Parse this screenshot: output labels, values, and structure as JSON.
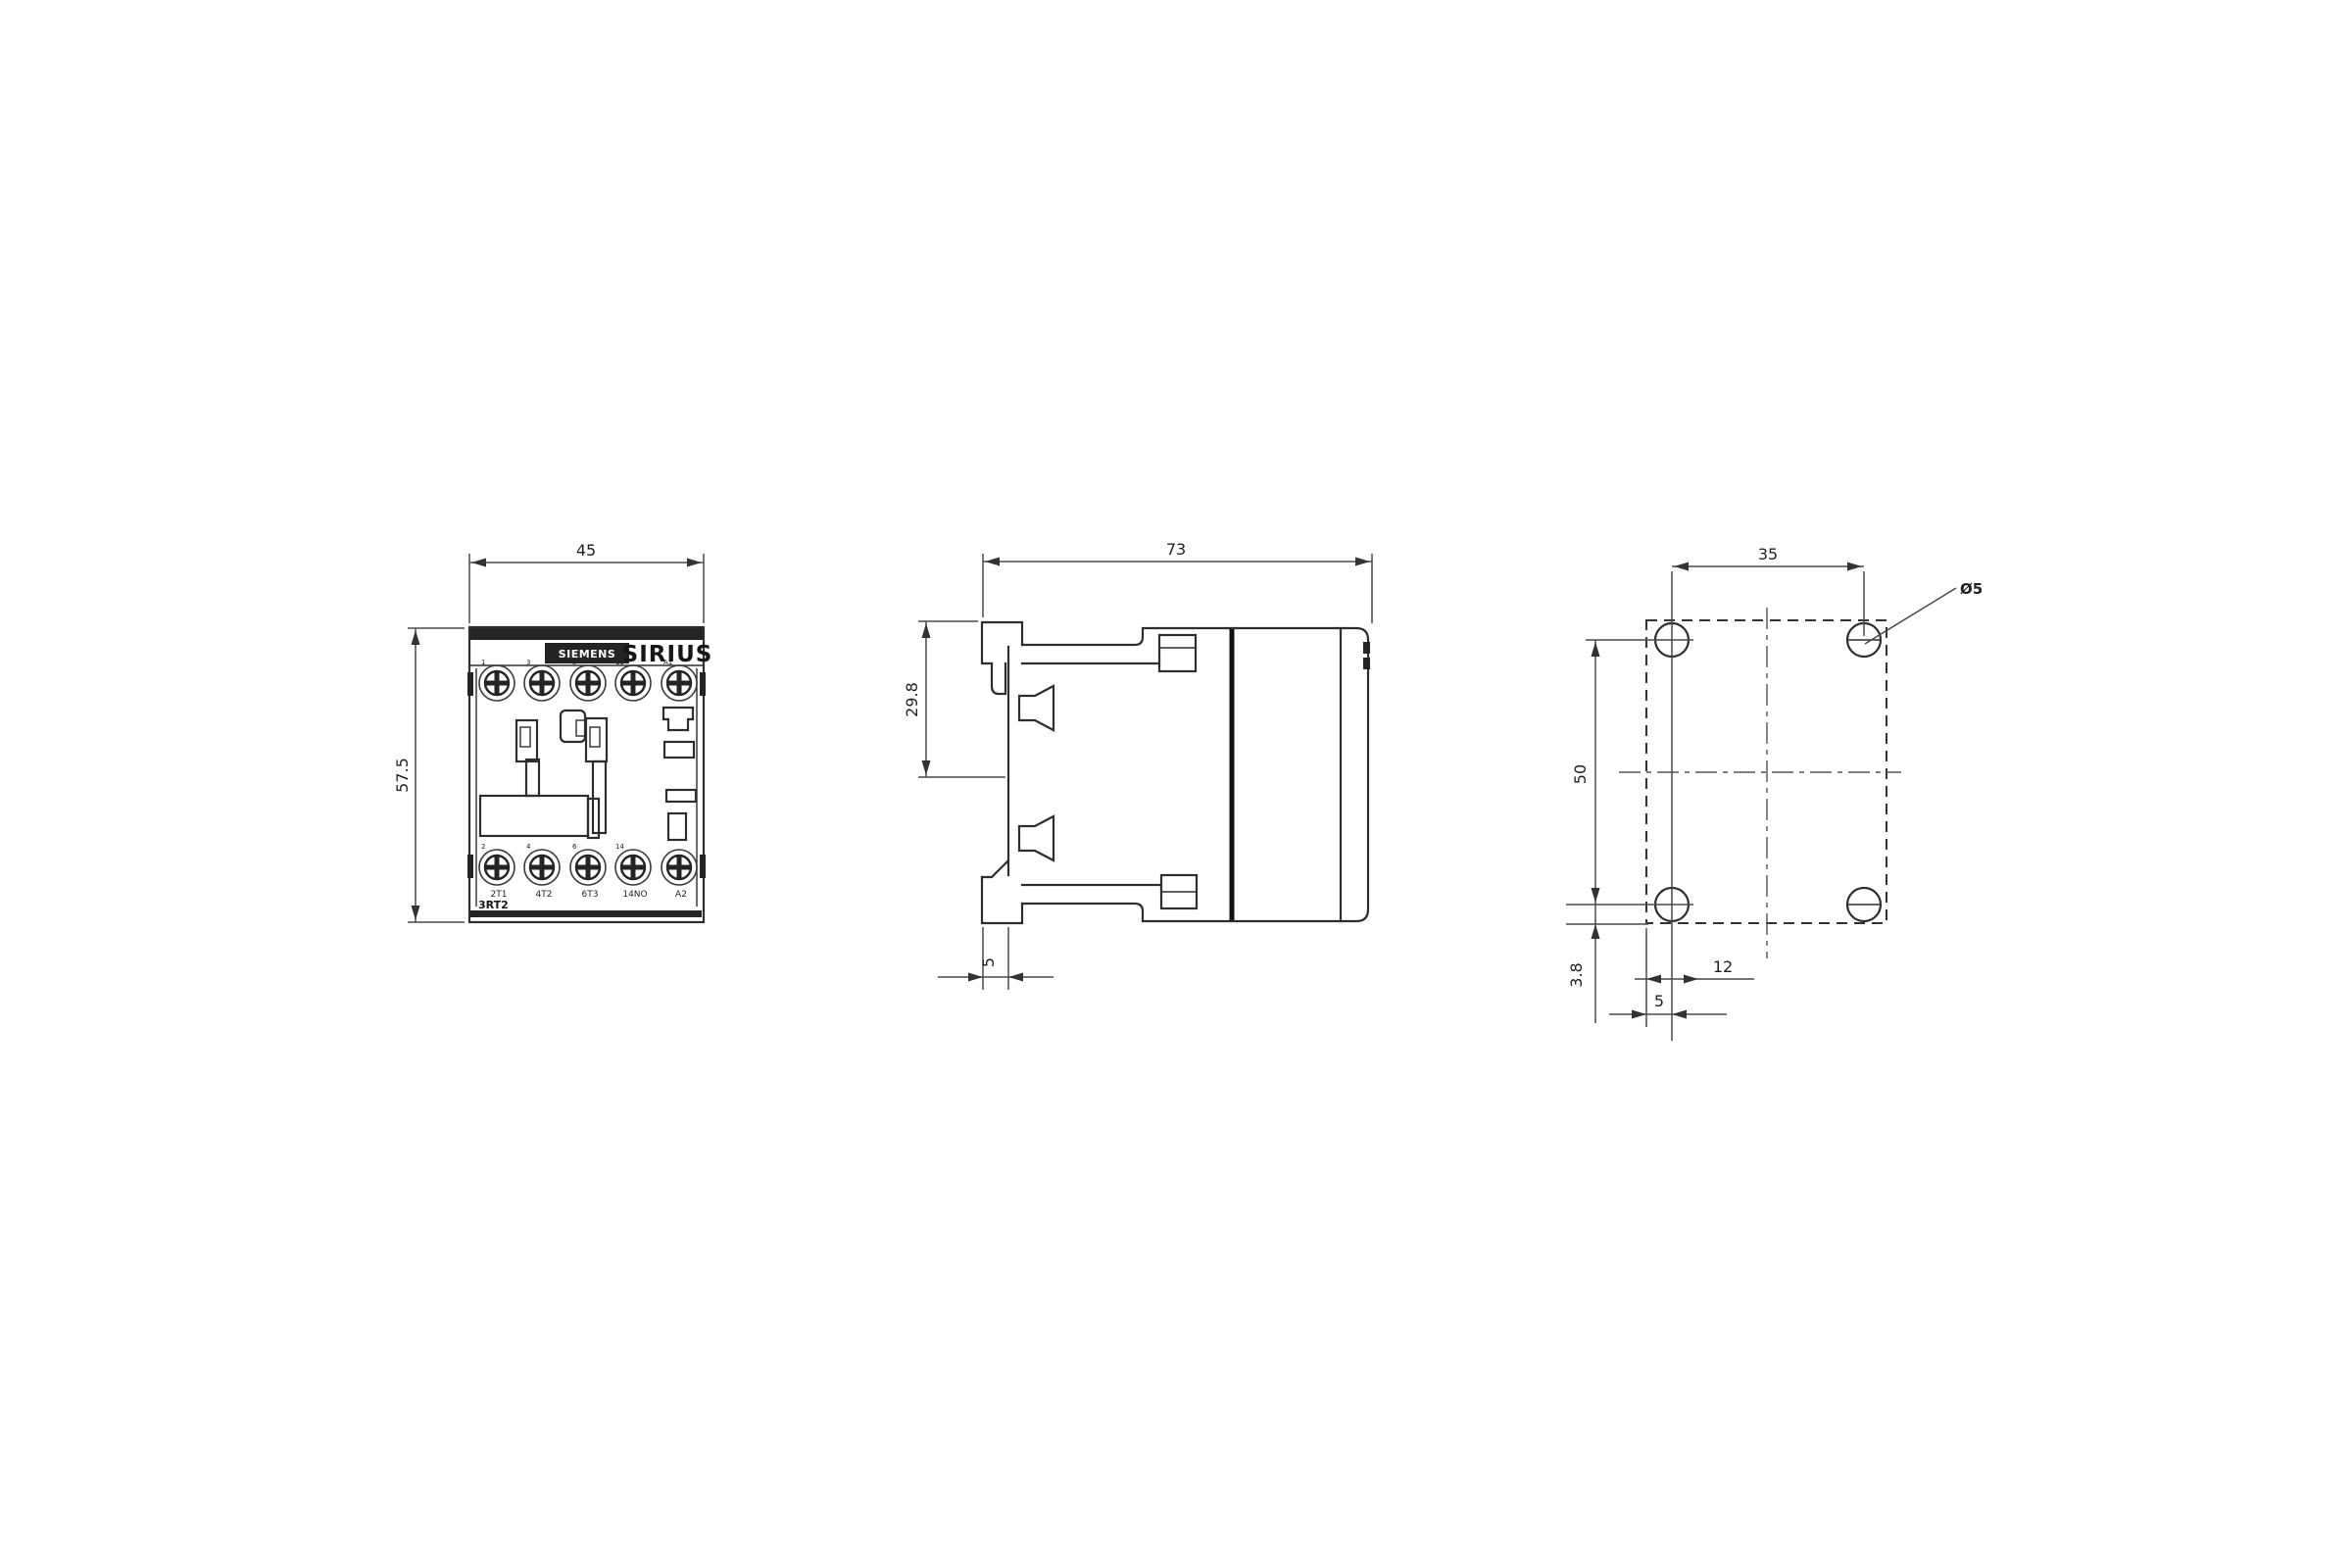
{
  "drawing": {
    "front_view": {
      "dim_width": "45",
      "dim_height": "57.5",
      "logo_text": "SIEMENS",
      "brand_text": "SIRIUS",
      "type_label": "3RT2",
      "terminal_numbers_top": [
        "1",
        "3",
        "5",
        "13",
        "A1"
      ],
      "terminal_numbers_bottom": [
        "2",
        "4",
        "6",
        "14",
        ""
      ],
      "terminal_labels_bottom": [
        "2T1",
        "4T2",
        "6T3",
        "14NO",
        "A2"
      ]
    },
    "side_view": {
      "dim_depth": "73",
      "dim_din_rail": "29.8",
      "dim_foot": "5"
    },
    "mounting_view": {
      "dim_hole_spacing_h": "35",
      "dim_hole_spacing_v": "50",
      "hole_diameter": "Ø5",
      "dim_hole_to_edge": "3.8",
      "dim_offset_12": "12",
      "dim_offset_5": "5"
    },
    "colors": {
      "line": "#2e2e2e",
      "dim_line": "#4a4a4a",
      "background": "#ffffff"
    }
  }
}
